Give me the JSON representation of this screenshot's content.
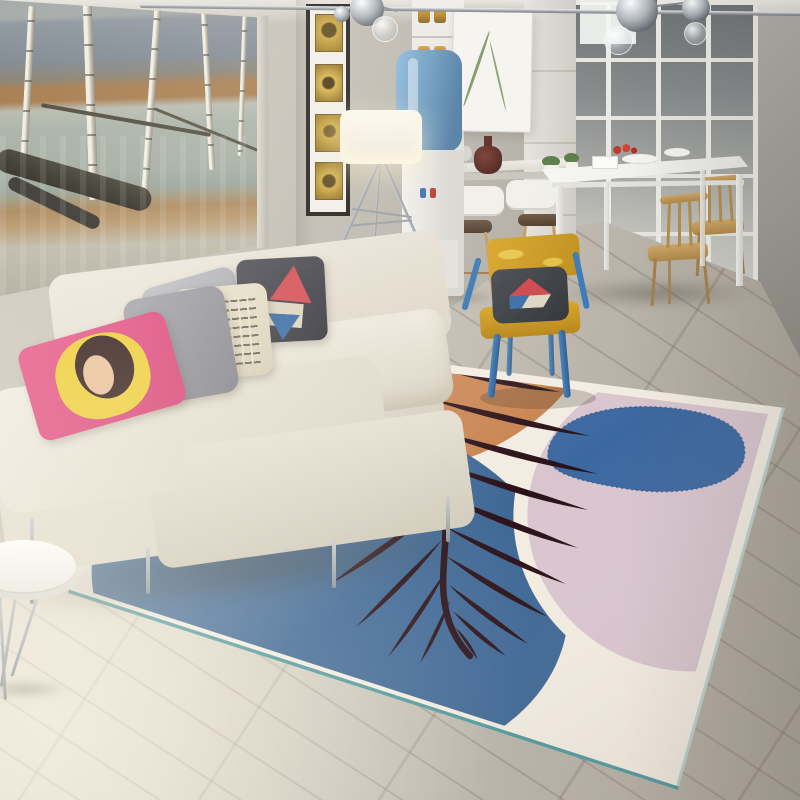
{
  "scene": {
    "description": "Modern Scandinavian living-dining room photo featuring an abstract area rug with a dark palm leaf motif over blue, orange and pink shapes, a cream fabric sofa with decorative pillows, a yellow armchair with blue legs, a landscape oil painting, a floor lamp, a water dispenser, a bar counter with stools and a white dining set by a white-framed glass partition."
  },
  "objects": {
    "scene": "living room interior photograph",
    "wall": "grey plastered wall",
    "floor": "light grey-beige wood plank floor laid diagonally",
    "painting": "large framed landscape oil painting of birch trees by an autumn river",
    "gallery_strip": "narrow black vertical frame with four small gold artworks",
    "storage_shelf": "white shelving unit with amber jars",
    "wall_art": "small white botanical print",
    "glass_partition": "white-framed glass partition to the kitchen",
    "pendant_lights": "chrome and glass globe pendant lamps",
    "ceiling_rail": "metal ceiling rail",
    "bar_counter": "white bar counter with seat cushions",
    "bar_stools": "wooden bar stools with dark seats",
    "wine_decanter": "dark red wine decanter and glass",
    "potted_plants": "two small green plants in white pots",
    "water_dispenser": "white water dispenser with blue bottle",
    "floor_lamp": "tripod floor lamp with white drum shade, lit",
    "dining_table": "white rectangular dining table with red flowers and dishes",
    "dining_chairs": "light wood spindle-back dining chairs",
    "area_rug": "abstract area rug: cream base, orange and pink organic shapes, large blue circle, dark palm leaf, teal edge trim",
    "accent_chair": "mustard yellow armchair with blue metal frame and triangle-patterned dark cushion",
    "sofa": "cream fabric three-seat sofa on thin chrome legs",
    "pillows": "throw pillows: pop-art portrait, grey, cream with lettering, dark with red and blue patches",
    "side_table": "round white side table with chrome legs"
  },
  "palette": {
    "wall": "#b9b4ac",
    "wall_right": "#a09c96",
    "ceiling": "#e7e4dd",
    "floor_light": "#dbd5c8",
    "floor_dark": "#a39b8e",
    "rug_base": "#f3ece1",
    "rug_orange": "#c98350",
    "rug_blue": "#3e6795",
    "rug_pink": "#d9c5ce",
    "rug_blob": "#3c68a0",
    "rug_blob_edge": "#2e5586",
    "rug_leaf": "#2a1118",
    "rug_trim": "#3f8f96",
    "sofa": "#e9e4d8",
    "chair_yellow": "#d9a72c",
    "chair_blue": "#3a7ab8",
    "wood_chair": "#c09b5f",
    "table_white": "#f4f4f2",
    "lamp_shade": "#f8f5ea",
    "bottle_blue": "#6f9fc4",
    "pillow_pink": "#e0517f",
    "pillow_yellow": "#eecf3e",
    "metal": "#9aa0a6"
  },
  "rug": {
    "outline": "147,326 785,408 678,790 68,593",
    "inner": "160,336 768,414 666,778 84,590",
    "trim_main": "68,593 678,790",
    "trim_side": "678,790 785,408",
    "orange": "M230,318 L592,352 C566,400 532,428 488,450 C428,478 348,474 296,452 L230,430 Z",
    "blue": {
      "cx": 330,
      "cy": 590,
      "rx": 240,
      "ry": 178,
      "rot": 10
    },
    "pink": {
      "cx": 688,
      "cy": 520,
      "rx": 168,
      "ry": 158,
      "rot": 12
    },
    "blob": "M548,452 C552,420 602,404 658,407 C724,411 750,431 744,459 C737,487 678,497 628,489 C584,482 544,474 548,452 Z",
    "leaf": {
      "stem": "M433,350 C424,390 424,415 432,450 C440,485 447,510 445,545 C443,575 441,595 448,618 C452,632 460,645 470,656",
      "leaflets": [
        [
          433,
          366,
          560,
          392,
          9
        ],
        [
          427,
          398,
          590,
          436,
          10
        ],
        [
          431,
          430,
          598,
          474,
          10
        ],
        [
          437,
          463,
          588,
          510,
          10
        ],
        [
          441,
          495,
          578,
          548,
          10
        ],
        [
          444,
          526,
          566,
          584,
          9
        ],
        [
          446,
          556,
          548,
          617,
          9
        ],
        [
          449,
          585,
          528,
          644,
          8
        ],
        [
          453,
          611,
          506,
          656,
          7
        ],
        [
          429,
          374,
          316,
          356,
          -8
        ],
        [
          424,
          406,
          300,
          410,
          -8
        ],
        [
          427,
          440,
          305,
          474,
          -9
        ],
        [
          433,
          474,
          312,
          532,
          -9
        ],
        [
          438,
          507,
          330,
          584,
          -9
        ],
        [
          442,
          540,
          356,
          627,
          -8
        ],
        [
          446,
          571,
          388,
          657,
          -7
        ],
        [
          450,
          600,
          420,
          663,
          -6
        ],
        [
          456,
          628,
          478,
          660,
          -5
        ]
      ]
    },
    "chair_shadow": {
      "cx": 538,
      "cy": 398,
      "rx": 58,
      "ry": 11
    }
  }
}
